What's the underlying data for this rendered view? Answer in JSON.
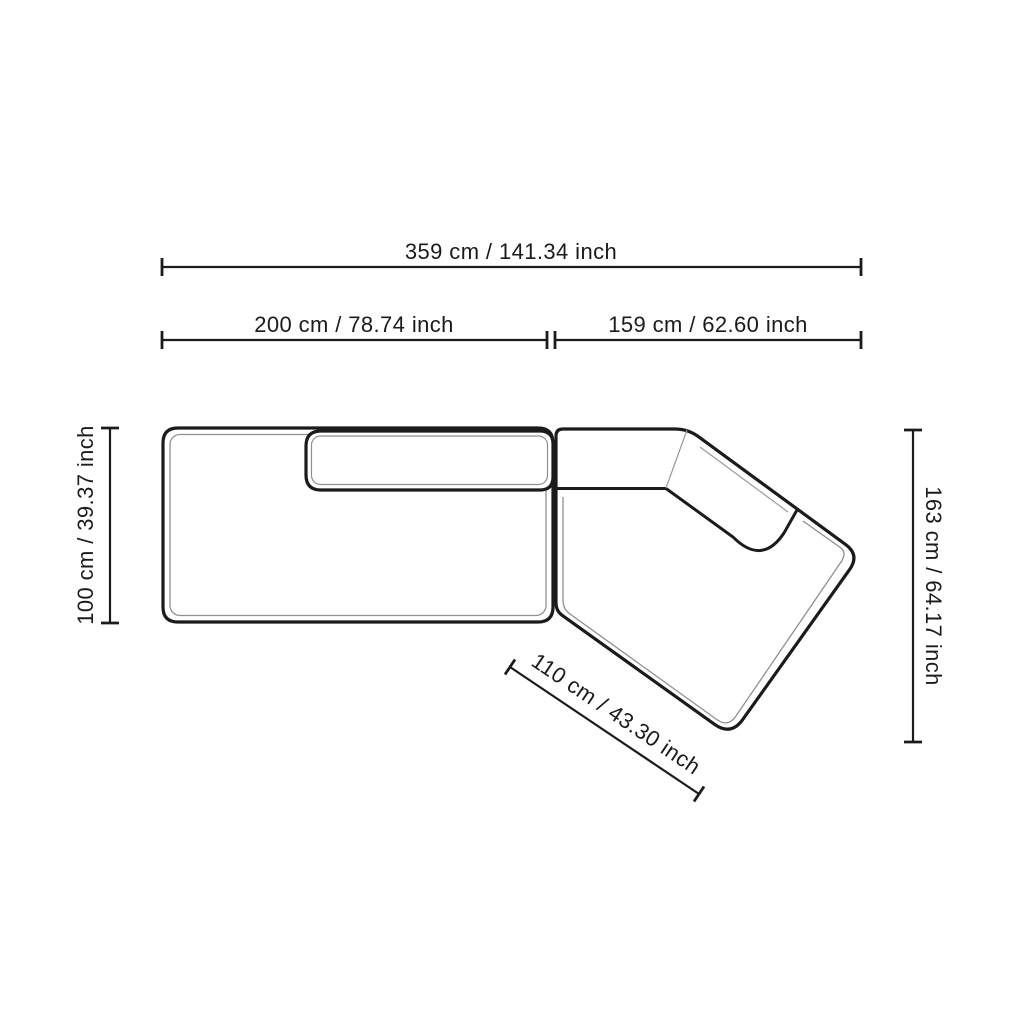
{
  "diagram": {
    "subject": "sectional-sofa-top-view-dimension-drawing",
    "colors": {
      "line": "#1b1b1b",
      "seam": "#8f8f8f",
      "background": "#ffffff"
    },
    "dimensions": {
      "total_width": "359 cm / 141.34 inch",
      "left_module_width": "200 cm / 78.74 inch",
      "right_module_width": "159 cm / 62.60 inch",
      "left_module_depth": "100 cm / 39.37 inch",
      "right_module_depth": "163 cm / 64.17 inch",
      "chaise_diagonal_depth": "110 cm / 43.30 inch"
    }
  }
}
